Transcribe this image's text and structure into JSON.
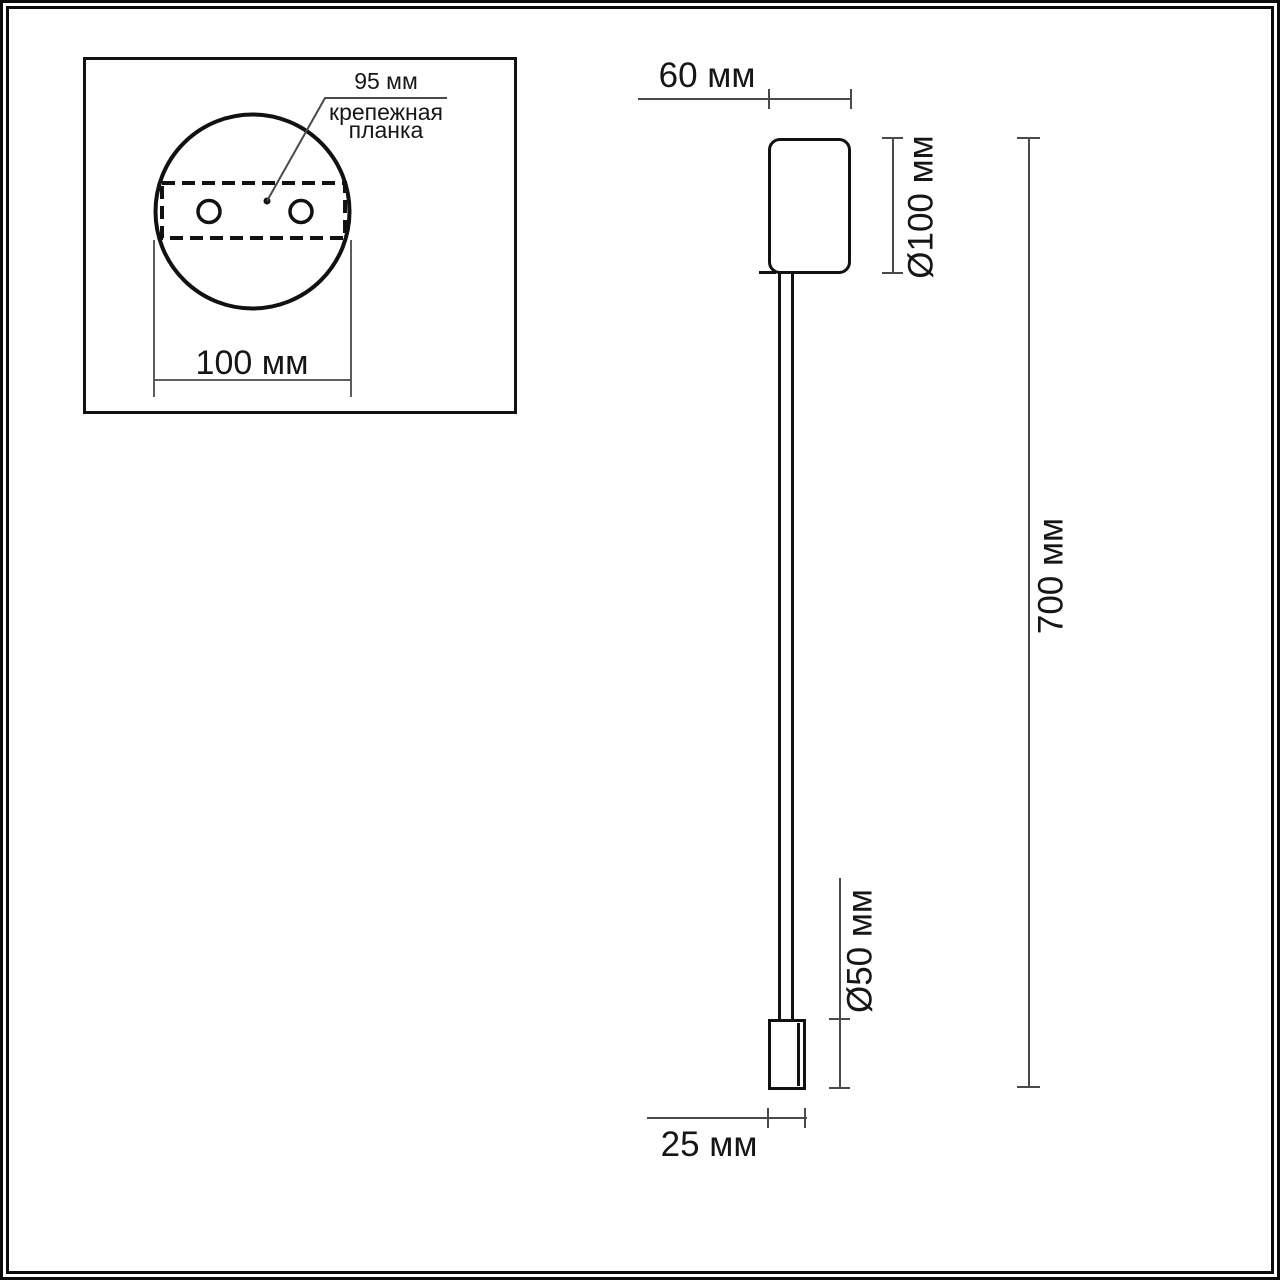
{
  "page": {
    "background": "#ffffff",
    "outline_color": "#111111",
    "dimension_line_color": "#4a4a4a",
    "text_color": "#161616"
  },
  "detail_view": {
    "plate_offset_label": "95 мм",
    "plate_name_label": "крепежная планка",
    "base_width_label": "100 мм"
  },
  "side_view": {
    "canopy_width_label": "60 мм",
    "canopy_diameter_label": "Ø100 мм",
    "total_height_label": "700 мм",
    "head_diameter_label": "Ø50 мм",
    "head_width_label": "25 мм"
  }
}
